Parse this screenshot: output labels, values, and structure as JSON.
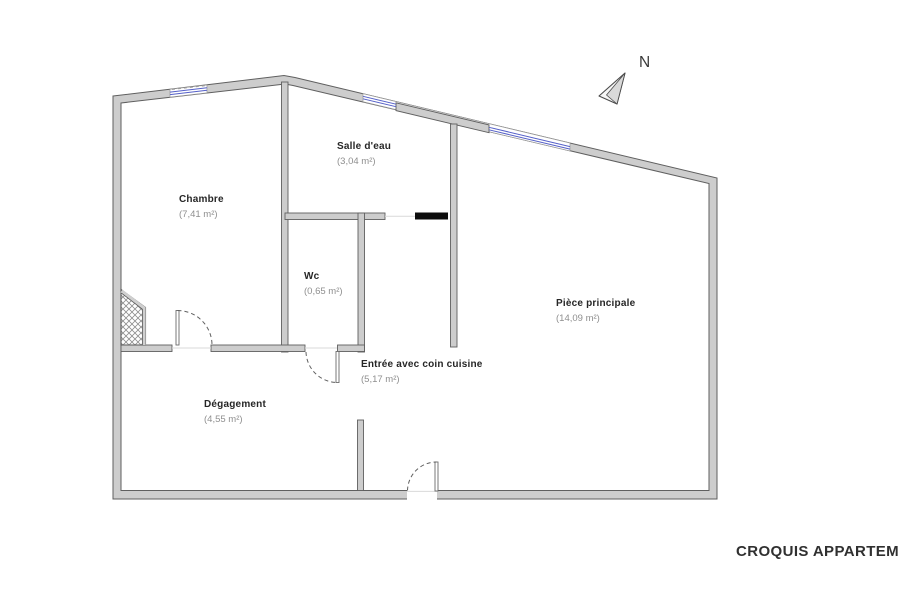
{
  "title": "CROQUIS APPARTEMENT",
  "compass": {
    "label": "N"
  },
  "rooms": [
    {
      "id": "chambre",
      "name": "Chambre",
      "area": "(7,41 m²)"
    },
    {
      "id": "salle-deau",
      "name": "Salle d'eau",
      "area": "(3,04 m²)"
    },
    {
      "id": "wc",
      "name": "Wc",
      "area": "(0,65 m²)"
    },
    {
      "id": "entree",
      "name": "Entrée avec coin cuisine",
      "area": "(5,17 m²)"
    },
    {
      "id": "piece-principale",
      "name": "Pièce principale",
      "area": "(14,09 m²)"
    },
    {
      "id": "degagement",
      "name": "Dégagement",
      "area": "(4,55 m²)"
    }
  ],
  "colors": {
    "wall_fill": "#cdcdcd",
    "wall_stroke": "#5f5f5f",
    "window_blue": "#5560c8",
    "door_dash": "#606060",
    "label_name": "#262626",
    "label_area": "#8f8f8f",
    "black_feature": "#0d0d0d",
    "title_color": "#303030"
  }
}
